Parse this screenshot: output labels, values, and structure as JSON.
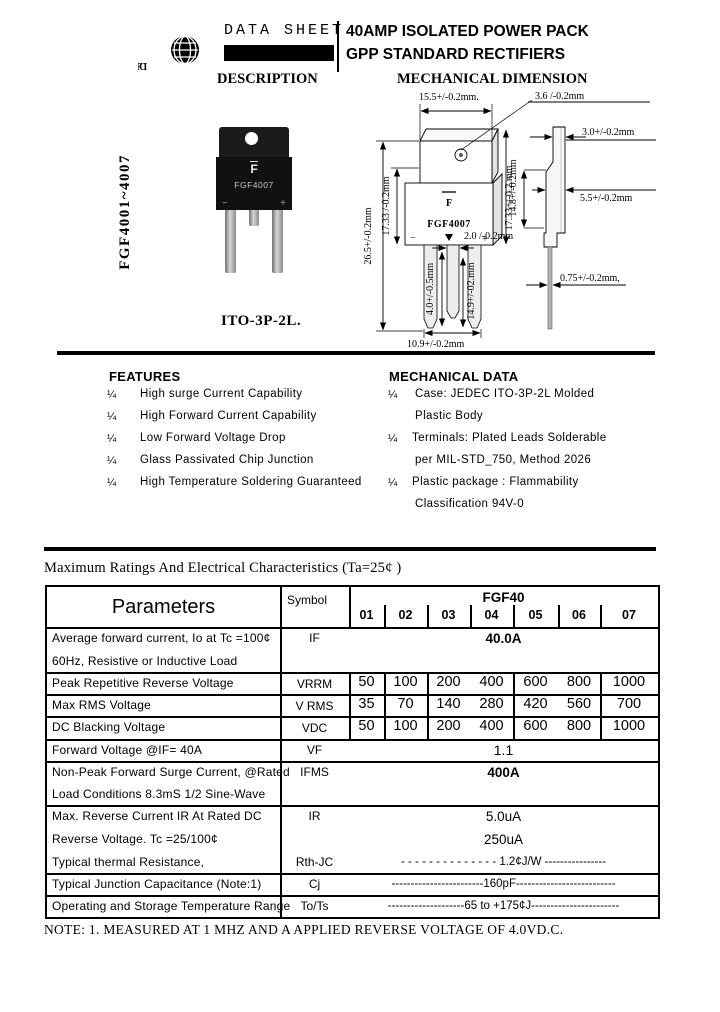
{
  "header": {
    "logo": "FCI",
    "data_sheet": "DATA SHEET",
    "title1": "40AMP ISOLATED POWER PACK",
    "title2": "GPP STANDARD RECTIFIERS"
  },
  "description": {
    "heading": "DESCRIPTION",
    "part_range": "FGF4001~4007",
    "package": "ITO-3P-2L.",
    "photo": {
      "logo": "F",
      "part": "FGF4007",
      "minus": "−",
      "plus": "+"
    }
  },
  "drawing": {
    "heading": "MECHANICAL DIMENSION",
    "front": {
      "logo": "F",
      "part": "FGF4007",
      "minus": "−",
      "plus": "+"
    },
    "dims": {
      "top_width": "15.5+/-0.2mm.",
      "hole_dia": "3.6 /-0.2mm",
      "tab_body_height": "14.8+/-0.2mm",
      "total_height": "26.5+/-0.2mm",
      "body_height": "17.33 /-0.2mm",
      "lead_width": "2.0 /-0.2mm",
      "mid_lead_length": "4.0+/-0.5mm",
      "lead_length": "14.9+/-02.mm",
      "lead_span": "10.9+/-0.2mm",
      "top_thickness": "3.0+/-0.2mm",
      "body_thickness": "5.5+/-0.2mm",
      "side_height": "17.33+/-0.2.mm",
      "lead_thickness": "0.75+/-0.2mm,"
    }
  },
  "features": {
    "heading": "FEATURES",
    "bullet": "¼",
    "items": [
      "High surge Current Capability",
      "High Forward Current Capability",
      "Low Forward Voltage Drop",
      "Glass Passivated Chip Junction",
      "High Temperature Soldering Guaranteed"
    ]
  },
  "mechanical_data": {
    "heading": "MECHANICAL DATA",
    "lines": [
      {
        "bullet": "¼",
        "text": "Case: JEDEC ITO-3P-2L Molded"
      },
      {
        "bullet": "",
        "text": "Plastic Body"
      },
      {
        "bullet": "¼",
        "text": "Terminals: Plated Leads Solderable"
      },
      {
        "bullet": "",
        "text": "per MIL-STD_750, Method 2026"
      },
      {
        "bullet": "¼",
        "text": "Plastic package : Flammability"
      },
      {
        "bullet": "",
        "text": "Classification 94V-0"
      }
    ]
  },
  "table": {
    "caption": "Maximum Ratings And Electrical Characteristics (Ta=25¢ )",
    "header": {
      "parameters": "Parameters",
      "symbol": "Symbol",
      "group": "FGF40",
      "cols": [
        "01",
        "02",
        "03",
        "04",
        "05",
        "06",
        "07"
      ]
    },
    "rows": {
      "if": {
        "line1": "Average forward current, Io at Tc =100¢",
        "line2": "60Hz, Resistive or Inductive Load",
        "symbol": "IF",
        "value": "40.0A"
      },
      "vrrm": {
        "param": "Peak Repetitive Reverse Voltage",
        "symbol": "VRRM",
        "values": [
          "50",
          "100",
          "200",
          "400",
          "600",
          "800",
          "1000"
        ]
      },
      "vrms": {
        "param": "Max RMS Voltage",
        "symbol": "V RMS",
        "values": [
          "35",
          "70",
          "140",
          "280",
          "420",
          "560",
          "700"
        ]
      },
      "vdc": {
        "param": "DC Blacking Voltage",
        "symbol": "VDC",
        "values": [
          "50",
          "100",
          "200",
          "400",
          "600",
          "800",
          "1000"
        ]
      },
      "vf": {
        "param": "Forward Voltage @IF= 40A",
        "symbol": "VF",
        "value": "1.1"
      },
      "ifms": {
        "line1": "Non-Peak Forward Surge Current, @Rated",
        "line2": "Load Conditions 8.3mS 1/2 Sine-Wave",
        "symbol": "IFMS",
        "value": "400A"
      },
      "ir": {
        "line1": "Max. Reverse Current IR At Rated DC",
        "line2": "Reverse Voltage. Tc =25/100¢",
        "line3": "Typical thermal Resistance,",
        "symbol1": "IR",
        "symbol3": "Rth-JC",
        "value1": "5.0uA",
        "value2": "250uA",
        "value3": "- - - - - - - - - - - - - -  1.2¢J/W  ----------------"
      },
      "cj": {
        "param": "Typical Junction Capacitance (Note:1)",
        "symbol": "Cj",
        "value": "------------------------160pF--------------------------"
      },
      "tots": {
        "param": "Operating and Storage Temperature Range",
        "symbol": "To/Ts",
        "value": "--------------------65 to +175¢J-----------------------"
      }
    }
  },
  "note": "NOTE: 1. MEASURED AT 1 MHZ AND A APPLIED REVERSE VOLTAGE OF 4.0VD.C."
}
